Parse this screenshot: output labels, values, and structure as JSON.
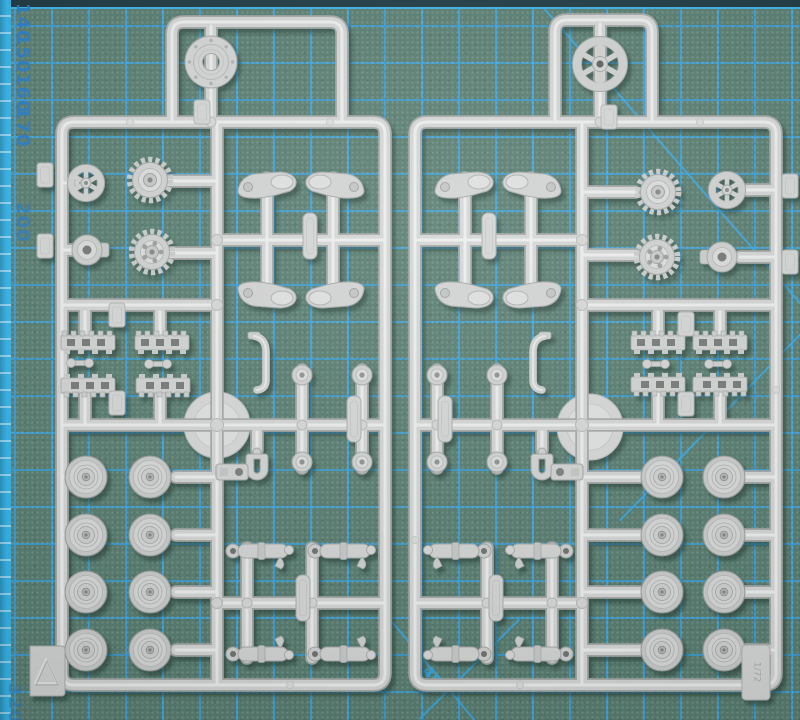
{
  "mat": {
    "ruler_numbers": [
      {
        "label": "140"
      },
      {
        "label": "150"
      },
      {
        "label": "160"
      },
      {
        "label": "170"
      },
      {
        "label": "200"
      },
      {
        "label": "320"
      }
    ],
    "angle_label": "45°",
    "colors": {
      "surface": "#5a7e72",
      "grid_line": "#38a2de",
      "edge_strip": "#38b4e7",
      "top_edge": "#1f3a44",
      "ruler_number_blue": "#2d7fc4"
    }
  },
  "sprues": {
    "plastic_color": "#d3d5d4",
    "left": {
      "corner_marker_icon": "triangle-arrow"
    },
    "right": {
      "scale_text": "1/72"
    },
    "part_types": [
      "spoked-idler-wheel",
      "drive-sprocket",
      "hub-cap",
      "ring-part",
      "road-wheel",
      "track-link-section",
      "fender-bracket",
      "return-roller",
      "suspension-cylinder",
      "tow-clevis",
      "pipe-bracket",
      "mounting-plate",
      "wheel-disc"
    ]
  }
}
